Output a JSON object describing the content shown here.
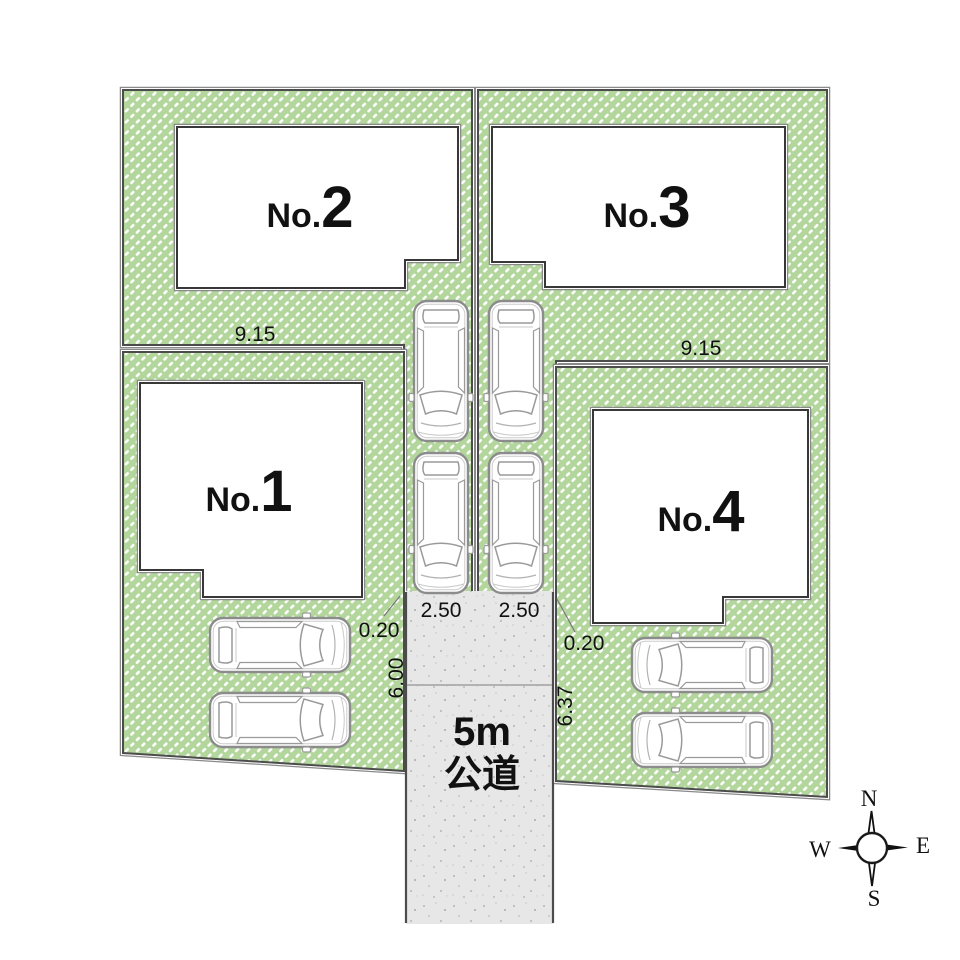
{
  "lots": {
    "no1": {
      "prefix": "No.",
      "number": "1"
    },
    "no2": {
      "prefix": "No.",
      "number": "2"
    },
    "no3": {
      "prefix": "No.",
      "number": "3"
    },
    "no4": {
      "prefix": "No.",
      "number": "4"
    }
  },
  "measurements": {
    "lot2_frontage": "9.15",
    "lot3_frontage": "9.15",
    "parking_left_width": "2.50",
    "parking_right_width": "2.50",
    "offset_left": "0.20",
    "offset_right": "0.20",
    "road_depth_left": "6.00",
    "road_depth_right": "6.37"
  },
  "road": {
    "line1": "5m",
    "line2": "公道"
  },
  "compass": {
    "north": "N",
    "south": "S",
    "east": "E",
    "west": "W"
  },
  "colors": {
    "lot_fill": "#b2d69b",
    "hatch_dash": "#ffffff",
    "road_fill": "#e7e7e7",
    "border_dark": "#4c4c4c",
    "building_edge": "#383838",
    "building_fill": "#ffffff",
    "text": "#111111"
  }
}
